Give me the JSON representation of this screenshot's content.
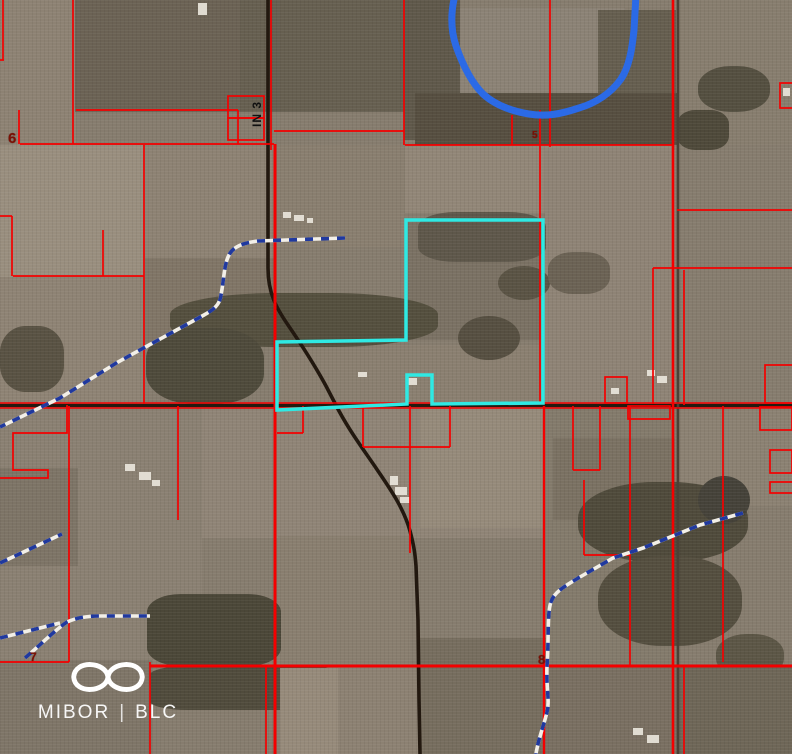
{
  "map": {
    "type": "aerial-parcel-map",
    "watermark": {
      "brand_left": "MIBOR",
      "divider": "|",
      "brand_right": "BLC"
    },
    "labels": {
      "route": "IN 3",
      "six": "6",
      "seven": "7",
      "eight": "8",
      "five": "5"
    },
    "colors": {
      "parcel_line": "#f40000",
      "highlight_parcel": "#2fe9e3",
      "water": "#2b6ae6",
      "stream_blue": "#20399f",
      "stream_white": "#f2efe8",
      "road_dark": "#22180f",
      "section_label": "#7c1004",
      "route_label": "#101010",
      "building": "#e9e5db"
    },
    "features": {
      "highlight_parcel": {
        "name": "highlighted-parcel-outline",
        "points": "406,220 543,220 543,403 432,404 432,375 407,375 407,404 277,410 277,342 406,340",
        "width": 3.5
      },
      "river": {
        "name": "river-line",
        "path": "M455,-5 C450,15 451,31 456,46 C462,63 470,81 483,94 C495,105 511,111 529,114 C546,117 561,114 579,108 C596,103 611,93 621,79 C629,67 632,50 634,30 L636,-5",
        "width": 7
      },
      "roads": [
        {
          "name": "road-state-route-3",
          "path": "M268,0 L268,268 C268,294 277,309 288,325 C301,344 313,362 326,386 L339,411 C351,433 363,449 376,468 C391,490 404,509 410,531 C414,546 415,553 416,566 L418,620 L419,700 L420,754",
          "color": "#22180f",
          "width": 3.6
        },
        {
          "name": "road-east-west",
          "path": "M0,405.5 L792,405.5",
          "color": "#241a10",
          "width": 3.2
        },
        {
          "name": "road-east-side",
          "path": "M678,0 L678,754",
          "color": "#4a4136",
          "width": 2.6
        }
      ],
      "streams": [
        {
          "name": "stream-upper-center",
          "path": "M345,238 L258,241 C242,243 233,247 229,255 C224,264 224,280 221,295 C220,305 213,310 204,315 L118,362 L60,398 L0,427"
        },
        {
          "name": "stream-left-upper",
          "path": "M0,563 L62,534"
        },
        {
          "name": "stream-left-lower",
          "path": "M25,658 C38,647 55,630 67,622 C78,617 90,616 100,616 L150,616"
        },
        {
          "name": "stream-left-lower-branch",
          "path": "M0,638 L60,623"
        },
        {
          "name": "stream-lower-right",
          "path": "M743,513 L700,525 L643,548 L613,558 L580,577 C565,586 554,592 551,602 C547,612 549,640 547,666 C546,690 550,700 547,712 C544,725 538,740 536,754"
        }
      ],
      "parcel_lines": [
        [
          3,
          0,
          3,
          60
        ],
        [
          0,
          60,
          4,
          60
        ],
        [
          73,
          0,
          73,
          144
        ],
        [
          19,
          110,
          19,
          144
        ],
        [
          76,
          110,
          238,
          110
        ],
        [
          238,
          110,
          238,
          144
        ],
        [
          20,
          144,
          274,
          144
        ],
        [
          274,
          131,
          404,
          131
        ],
        [
          404,
          0,
          404,
          145
        ],
        [
          405,
          145,
          672,
          145
        ],
        [
          512,
          115,
          512,
          145
        ],
        [
          540,
          110,
          540,
          404
        ],
        [
          550,
          0,
          550,
          147
        ],
        [
          673,
          0,
          673,
          754,
          2.6
        ],
        [
          684,
          270,
          684,
          405
        ],
        [
          684,
          666,
          684,
          754
        ],
        [
          677,
          210,
          792,
          210
        ],
        [
          653,
          268,
          792,
          268
        ],
        [
          653,
          268,
          653,
          404
        ],
        [
          103,
          230,
          103,
          276
        ],
        [
          13,
          276,
          144,
          276
        ],
        [
          0,
          216,
          12,
          216
        ],
        [
          12,
          216,
          12,
          276
        ],
        [
          144,
          145,
          144,
          404
        ],
        [
          275,
          144,
          275,
          754,
          3
        ],
        [
          271,
          0,
          271,
          150
        ],
        [
          69,
          406,
          69,
          662
        ],
        [
          178,
          406,
          178,
          520
        ],
        [
          303,
          406,
          303,
          433
        ],
        [
          277,
          433,
          303,
          433
        ],
        [
          363,
          406,
          363,
          447
        ],
        [
          450,
          406,
          450,
          447
        ],
        [
          363,
          447,
          450,
          447
        ],
        [
          410,
          406,
          410,
          553
        ],
        [
          573,
          406,
          573,
          470
        ],
        [
          600,
          406,
          600,
          470
        ],
        [
          573,
          470,
          600,
          470
        ],
        [
          584,
          480,
          584,
          555
        ],
        [
          584,
          555,
          630,
          555
        ],
        [
          630,
          406,
          630,
          666
        ],
        [
          723,
          406,
          723,
          662
        ],
        [
          544,
          406,
          544,
          754,
          2.4
        ],
        [
          0,
          662,
          69,
          662
        ],
        [
          150,
          662,
          150,
          754
        ],
        [
          150,
          666,
          792,
          666,
          3
        ],
        [
          266,
          666,
          266,
          754
        ],
        [
          0,
          403,
          792,
          403,
          1.6
        ],
        [
          0,
          408,
          792,
          408,
          1.6
        ]
      ],
      "parcel_paths": [
        "M67,405 L67,433 L13,433 L13,470 L48,470 L48,478 L0,478"
      ],
      "parcel_boxes": [
        [
          228,
          96,
          36,
          22
        ],
        [
          228,
          118,
          36,
          22
        ],
        [
          780,
          83,
          16,
          25
        ],
        [
          770,
          482,
          24,
          11
        ],
        [
          765,
          365,
          28,
          38
        ],
        [
          760,
          407,
          32,
          23
        ],
        [
          770,
          450,
          22,
          23
        ],
        [
          605,
          377,
          22,
          26
        ],
        [
          628,
          406,
          42,
          13
        ]
      ],
      "buildings": [
        [
          198,
          3,
          9,
          12
        ],
        [
          283,
          212,
          8,
          6
        ],
        [
          294,
          215,
          10,
          6
        ],
        [
          307,
          218,
          6,
          5
        ],
        [
          408,
          378,
          9,
          7
        ],
        [
          358,
          372,
          9,
          5
        ],
        [
          390,
          476,
          8,
          9
        ],
        [
          395,
          487,
          12,
          8
        ],
        [
          400,
          497,
          10,
          6
        ],
        [
          125,
          464,
          10,
          7
        ],
        [
          139,
          472,
          12,
          8
        ],
        [
          152,
          480,
          8,
          6
        ],
        [
          647,
          370,
          8,
          6
        ],
        [
          657,
          376,
          10,
          7
        ],
        [
          783,
          88,
          7,
          8
        ],
        [
          633,
          728,
          10,
          7
        ],
        [
          647,
          735,
          12,
          8
        ],
        [
          611,
          388,
          8,
          6
        ]
      ]
    }
  }
}
